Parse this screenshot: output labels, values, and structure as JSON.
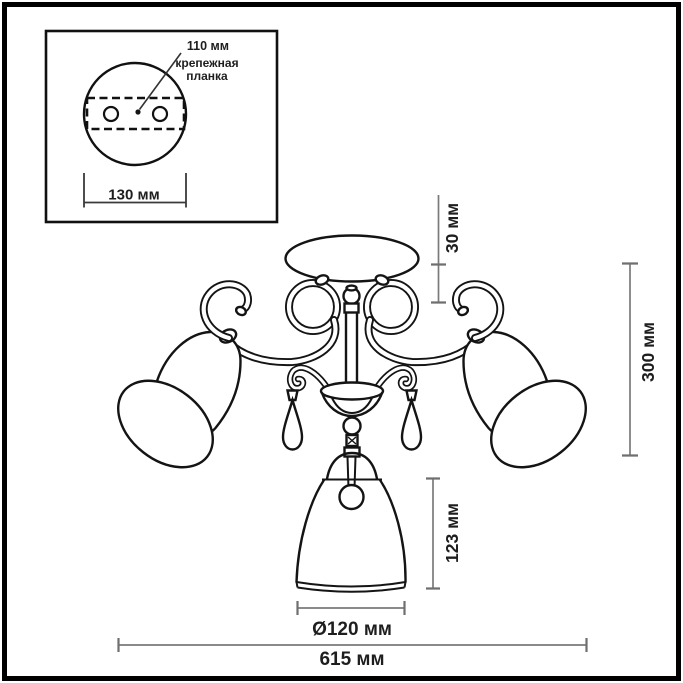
{
  "inset": {
    "hole_spacing_label": "110 мм",
    "mounting_bar_label": [
      "крепежная",
      "планка"
    ],
    "base_width_label": "130 мм"
  },
  "main": {
    "canopy_height_label": "30 мм",
    "overall_height_label": "300 мм",
    "center_shade_height_label": "123 мм",
    "center_shade_diameter_label": "Ø120 мм",
    "overall_width_label": "615 мм"
  },
  "colors": {
    "background": "#ffffff",
    "frame": "#000000",
    "drawing_line": "#141414",
    "dimension_line": "#7a7a7a",
    "text": "#1e1e1e"
  }
}
